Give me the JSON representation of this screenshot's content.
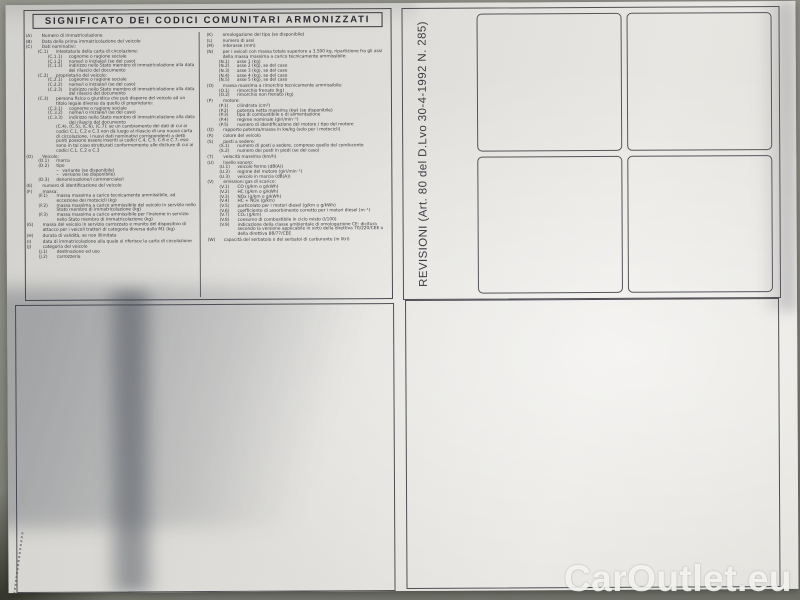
{
  "document": {
    "title": "SIGNIFICATO DEI CODICI COMUNITARI ARMONIZZATI",
    "revisioni_label": "REVISIONI (Art. 80 del D.Lvo 30-4-1992 N. 285)",
    "watermark": "CarOutlet.eu",
    "codes_left": [
      {
        "code": "(A)",
        "text": "Numero di immatricolazione",
        "level": 0
      },
      {
        "code": "(B)",
        "text": "Data della prima immatricolazione del veicolo",
        "level": 0
      },
      {
        "code": "(C)",
        "text": "Dati nominativi:",
        "level": 0
      },
      {
        "code": "(C.1)",
        "text": "intestatario della carta di circolazione:",
        "level": 1
      },
      {
        "code": "(C.1.1)",
        "text": "cognome o ragione sociale",
        "level": 2
      },
      {
        "code": "(C.1.2)",
        "text": "nome/i o iniziale/i (se del caso)",
        "level": 2
      },
      {
        "code": "(C.1.3)",
        "text": "indirizzo nello Stato membro di immatricolazione alla data del rilascio del documento",
        "level": 2
      },
      {
        "code": "(C.2)",
        "text": "proprietario del veicolo:",
        "level": 1
      },
      {
        "code": "(C.2.1)",
        "text": "cognome o ragione sociale",
        "level": 2
      },
      {
        "code": "(C.2.2)",
        "text": "nome/i o iniziale/i (se del caso)",
        "level": 2
      },
      {
        "code": "(C.2.3)",
        "text": "indirizzo nello Stato membro di immatricolazione alla data del rilascio del documento",
        "level": 2
      },
      {
        "code": "(C.3)",
        "text": "persona fisica o giuridica che può disporre del veicolo ad un titolo legale diverso da quello di proprietario:",
        "level": 1
      },
      {
        "code": "(C.3.1)",
        "text": "cognome o ragione sociale",
        "level": 2
      },
      {
        "code": "(C.3.2)",
        "text": "nome/i o iniziale/i (se del caso)",
        "level": 2
      },
      {
        "code": "(C.3.3)",
        "text": "indirizzo nello Stato membro di immatricolazione alla data del rilascio del documento",
        "level": 2
      },
      {
        "code": "",
        "text": "(C.4), (C.5), (C.6), (C.7): se un cambiamento dei dati di cui ai codici C.1, C.2 e C.3 non dà luogo al rilascio di una nuova carta di circolazione, i nuovi dati nominativi corrispondenti a detti punti possono essere inseriti ai codici C.4, C.5, C.6 e C.7; essi sono in tal caso strutturati conformemente alle diciture di cui ai codici C.1, C.2 e C.3",
        "level": 1
      },
      {
        "code": "(D)",
        "text": "Veicolo:",
        "level": 0
      },
      {
        "code": "(D.1)",
        "text": "marca",
        "level": 1
      },
      {
        "code": "(D.2)",
        "text": "tipo",
        "level": 1
      },
      {
        "code": "–",
        "text": "variante (se disponibile)",
        "level": 3
      },
      {
        "code": "–",
        "text": "versione (se disponibile)",
        "level": 3
      },
      {
        "code": "(D.3)",
        "text": "denominazione/i commerciale/i",
        "level": 1
      },
      {
        "code": "(E)",
        "text": "numero di identificazione del veicolo",
        "level": 0
      },
      {
        "code": "(F)",
        "text": "massa:",
        "level": 0
      },
      {
        "code": "(F.1)",
        "text": "massa massima a carico tecnicamente ammissibile, ad eccezione dei motocicli (kg)",
        "level": 1
      },
      {
        "code": "(F.2)",
        "text": "massa massima a carico ammissibile del veicolo in servizio nello Stato membro di immatricolazione (kg)",
        "level": 1
      },
      {
        "code": "(F.3)",
        "text": "massa massima a carico ammissibile per l'insieme in servizio nello Stato membro di immatricolazione (kg)",
        "level": 1
      },
      {
        "code": "(G)",
        "text": "massa del veicolo in servizio carrozzato e munito del dispositivo di attacco per i veicoli trattori di categoria diversa dalla M1 (kg)",
        "level": 0
      },
      {
        "code": "(H)",
        "text": "durata di validità, se non illimitata",
        "level": 0
      },
      {
        "code": "(I)",
        "text": "data di immatricolazione alla quale si riferisce la carta di circolazione",
        "level": 0
      },
      {
        "code": "(J)",
        "text": "categoria del veicolo",
        "level": 0
      },
      {
        "code": "(J.1)",
        "text": "destinazione ed uso",
        "level": 1
      },
      {
        "code": "(J.2)",
        "text": "carrozzeria",
        "level": 1
      }
    ],
    "codes_right": [
      {
        "code": "(K)",
        "text": "omologazione del tipo (se disponibile)",
        "level": 0
      },
      {
        "code": "(L)",
        "text": "numero di assi",
        "level": 0
      },
      {
        "code": "(M)",
        "text": "interasse (mm)",
        "level": 0
      },
      {
        "code": "(N)",
        "text": "per i veicoli con massa totale superiore a 3.500 kg, ripartizione fra gli assi della massa massima a carico tecnicamente ammissibile:",
        "level": 0
      },
      {
        "code": "(N.1)",
        "text": "asse 1 (kg)",
        "level": 1
      },
      {
        "code": "(N.2)",
        "text": "asse 2 (kg), se del caso",
        "level": 1
      },
      {
        "code": "(N.3)",
        "text": "asse 3 (kg), se del caso",
        "level": 1
      },
      {
        "code": "(N.4)",
        "text": "asse 4 (kg), se del caso",
        "level": 1
      },
      {
        "code": "(N.5)",
        "text": "asse 5 (kg), se del caso",
        "level": 1
      },
      {
        "code": "(O)",
        "text": "massa massima a rimorchio tecnicamente ammissibile:",
        "level": 0
      },
      {
        "code": "(O.1)",
        "text": "rimorchio frenato (kg)",
        "level": 1
      },
      {
        "code": "(O.2)",
        "text": "rimorchio non frenato (kg)",
        "level": 1
      },
      {
        "code": "(P)",
        "text": "motore:",
        "level": 0
      },
      {
        "code": "(P.1)",
        "text": "cilindrata (cm³)",
        "level": 1
      },
      {
        "code": "(P.2)",
        "text": "potenza netta massima (kw) (se disponibile)",
        "level": 1
      },
      {
        "code": "(P.3)",
        "text": "tipo di combustibile o di alimentazione",
        "level": 1
      },
      {
        "code": "(P.4)",
        "text": "regime nominale (giri/min⁻¹)",
        "level": 1
      },
      {
        "code": "(P.5)",
        "text": "numero di identificazione del motore / tipo del motore",
        "level": 1
      },
      {
        "code": "(Q)",
        "text": "rapporto potenza/massa in kw/kg (solo per i motocicli)",
        "level": 0
      },
      {
        "code": "(R)",
        "text": "colore del veicolo",
        "level": 0
      },
      {
        "code": "(S)",
        "text": "posti a sedere:",
        "level": 0
      },
      {
        "code": "(S.1)",
        "text": "numero di posti a sedere, compreso quello del conducente",
        "level": 1
      },
      {
        "code": "(S.2)",
        "text": "numero dei posti in piedi (se del caso)",
        "level": 1
      },
      {
        "code": "(T)",
        "text": "velocità massima (km/h)",
        "level": 0
      },
      {
        "code": "(U)",
        "text": "livello sonoro:",
        "level": 0
      },
      {
        "code": "(U.1)",
        "text": "veicolo fermo (dB(A))",
        "level": 1
      },
      {
        "code": "(U.2)",
        "text": "regime del motore (giri/min⁻¹)",
        "level": 1
      },
      {
        "code": "(U.3)",
        "text": "veicolo in marcia (dB(A))",
        "level": 1
      },
      {
        "code": "(V)",
        "text": "emissioni gas di scarico:",
        "level": 0
      },
      {
        "code": "(V.1)",
        "text": "CO (g/km o g/kWh)",
        "level": 1
      },
      {
        "code": "(V.2)",
        "text": "HC (g/km o g/kWh)",
        "level": 1
      },
      {
        "code": "(V.3)",
        "text": "NOx (g/km o g/kWh)",
        "level": 1
      },
      {
        "code": "(V.4)",
        "text": "HC + NOx (g/km)",
        "level": 1
      },
      {
        "code": "(V.5)",
        "text": "particolato per i motori diesel (g/km o g/kWh)",
        "level": 1
      },
      {
        "code": "(V.6)",
        "text": "coefficiente di assorbimento corretto per i motori diesel (m⁻¹)",
        "level": 1
      },
      {
        "code": "(V.7)",
        "text": "CO₂ (g/km)",
        "level": 1
      },
      {
        "code": "(V.8)",
        "text": "consumo di combustibile in ciclo misto (l/100)",
        "level": 1
      },
      {
        "code": "(V.9)",
        "text": "indicazione della classe ambientale di omologazione CE: dicitura secondo la versione applicabile in virtù della direttiva 70/220/CEE o della direttiva 88/77/CEE",
        "level": 1
      },
      {
        "code": "(W)",
        "text": "capacità del serbatoio o dei serbatoi di carburante (in litri)",
        "level": 0
      }
    ]
  }
}
